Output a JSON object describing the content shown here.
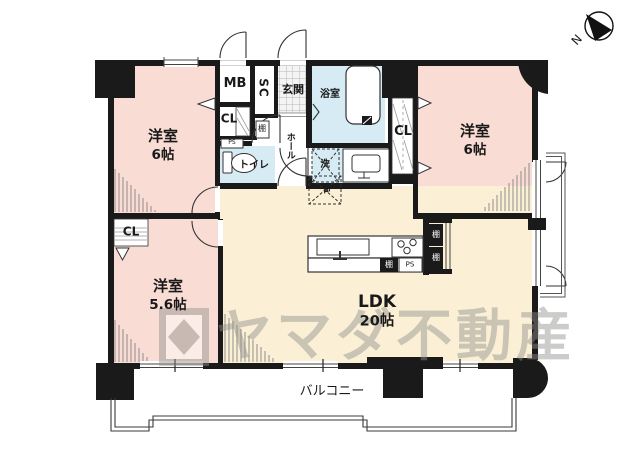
{
  "compass": {
    "north_label": "N"
  },
  "watermark": {
    "brand": "ヤマダ不動産"
  },
  "rooms": {
    "bedroom_top_left": {
      "name": "洋室",
      "size": "6帖"
    },
    "bedroom_top_right": {
      "name": "洋室",
      "size": "6帖"
    },
    "bedroom_bottom_left": {
      "name": "洋室",
      "size": "5.6帖"
    },
    "ldk": {
      "name": "LDK",
      "size": "20帖"
    },
    "balcony": {
      "name": "バルコニー"
    },
    "entrance": {
      "name": "玄関"
    },
    "bathroom": {
      "name": "浴室"
    },
    "toilet": {
      "name": "トイレ"
    },
    "hall": {
      "name": "ホール"
    }
  },
  "fixtures": {
    "meter_box": "MB",
    "shoe_closet": "SC",
    "closet": "CL",
    "pipe_space": "PS",
    "shelf": "棚",
    "washer": "洗",
    "refrigerator": "冷"
  },
  "colors": {
    "bedroom": "#f9ddd5",
    "ldk": "#fbf0d6",
    "wet_area": "#d6ebf4",
    "wall": "#1a1a1a",
    "watermark": "#8f8f8b"
  }
}
